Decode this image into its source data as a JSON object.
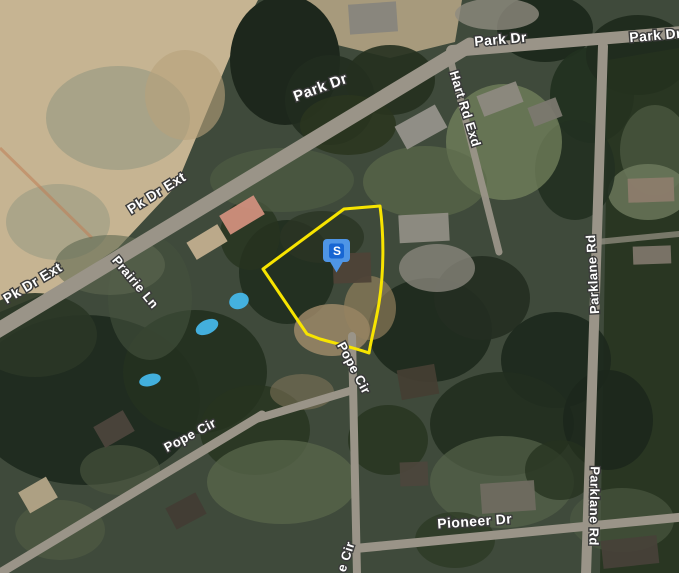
{
  "window": {
    "width": 679,
    "height": 573,
    "view": "satellite-map"
  },
  "map": {
    "marker": {
      "letter": "S",
      "tip_x": 336.5,
      "tip_y": 272.5,
      "outer_color": "#4e95e6",
      "inner_color": "#1766d3",
      "letter_color": "#ffffff"
    },
    "parcel": {
      "outline_color": "#f7e400",
      "outline_width": 3,
      "path": "M263,269 L344,209 L380,206 C384,235 384,272 379,303 C376,322 371,340 369,353 C358,349 338,344 320,339 L307,334 Z"
    },
    "road_labels": [
      {
        "text": "Park Dr",
        "x": 322,
        "y": 92,
        "rot": -20,
        "size": 15
      },
      {
        "text": "Park Dr",
        "x": 501,
        "y": 44,
        "rot": -5,
        "size": 14
      },
      {
        "text": "Park Dr",
        "x": 656,
        "y": 40,
        "rot": -5,
        "size": 14
      },
      {
        "text": "Hart Rd Exd",
        "x": 461,
        "y": 110,
        "rot": 73,
        "size": 13
      },
      {
        "text": "Pk Dr Ext",
        "x": 159,
        "y": 197,
        "rot": -32,
        "size": 14
      },
      {
        "text": "Pk Dr Ext",
        "x": 35,
        "y": 287,
        "rot": -31,
        "size": 14
      },
      {
        "text": "Prairie Ln",
        "x": 132,
        "y": 285,
        "rot": 50,
        "size": 13
      },
      {
        "text": "Pope Cir",
        "x": 350,
        "y": 370,
        "rot": 62,
        "size": 13
      },
      {
        "text": "Pope Cir",
        "x": 192,
        "y": 439,
        "rot": -28,
        "size": 13
      },
      {
        "text": "Parklane Rd",
        "x": 597,
        "y": 274,
        "rot": -93,
        "size": 13
      },
      {
        "text": "Parklane Rd",
        "x": 590,
        "y": 506,
        "rot": 91,
        "size": 13
      },
      {
        "text": "Pioneer Dr",
        "x": 475,
        "y": 526,
        "rot": -4,
        "size": 14
      },
      {
        "text": "e Cir",
        "x": 350,
        "y": 558,
        "rot": -72,
        "size": 13
      }
    ],
    "roads": [
      {
        "name": "pk-dr-ext-main",
        "x1": -8,
        "y1": 334,
        "x2": 470,
        "y2": 45,
        "w": 15,
        "o": 1
      },
      {
        "name": "park-dr-east",
        "x1": 452,
        "y1": 51,
        "x2": 683,
        "y2": 32,
        "w": 12,
        "o": 1
      },
      {
        "name": "hart-rd-exd",
        "x1": 450,
        "y1": 58,
        "x2": 499,
        "y2": 252,
        "w": 7,
        "o": 0.95
      },
      {
        "name": "parklane-rd",
        "x1": 603,
        "y1": 46,
        "x2": 586,
        "y2": 575,
        "w": 10,
        "o": 1
      },
      {
        "name": "pope-cir-sw",
        "x1": -5,
        "y1": 576,
        "x2": 262,
        "y2": 415,
        "w": 9,
        "o": 1
      },
      {
        "name": "pope-cir-mid",
        "x1": 256,
        "y1": 419,
        "x2": 353,
        "y2": 390,
        "w": 8,
        "o": 1
      },
      {
        "name": "pope-cir-ns",
        "x1": 352,
        "y1": 336,
        "x2": 357,
        "y2": 575,
        "w": 8,
        "o": 1
      },
      {
        "name": "pioneer-dr",
        "x1": 350,
        "y1": 549,
        "x2": 683,
        "y2": 517,
        "w": 9,
        "o": 1
      },
      {
        "name": "parklane-stub",
        "x1": 597,
        "y1": 242,
        "x2": 679,
        "y2": 234,
        "w": 6,
        "o": 0.7
      }
    ],
    "road_color": "#9a9488",
    "terrain": {
      "base_color": "#3f4a3b",
      "patches": [
        {
          "t": "poly",
          "pts": "0,0 258,0 236,42 176,186 118,248 58,288 0,312",
          "f": "#c6b492",
          "o": 1
        },
        {
          "t": "ell",
          "cx": 118,
          "cy": 118,
          "rx": 72,
          "ry": 52,
          "f": "#8f957f",
          "o": 0.55
        },
        {
          "t": "ell",
          "cx": 58,
          "cy": 222,
          "rx": 52,
          "ry": 38,
          "f": "#8f957f",
          "o": 0.5
        },
        {
          "t": "ell",
          "cx": 185,
          "cy": 95,
          "rx": 40,
          "ry": 45,
          "f": "#b7a27b",
          "o": 0.6
        },
        {
          "t": "line",
          "x1": 0,
          "y1": 148,
          "x2": 92,
          "y2": 238,
          "s": "#bf7e55",
          "w": 3,
          "o": 0.55
        },
        {
          "t": "poly",
          "pts": "300,0 462,0 455,42 390,58 325,42",
          "f": "#b3a384",
          "o": 0.9
        },
        {
          "t": "ell",
          "cx": 285,
          "cy": 60,
          "rx": 55,
          "ry": 65,
          "f": "#1d271c",
          "o": 1
        },
        {
          "t": "ell",
          "cx": 330,
          "cy": 100,
          "rx": 45,
          "ry": 45,
          "f": "#212c1f",
          "o": 0.9
        },
        {
          "t": "ell",
          "cx": 390,
          "cy": 80,
          "rx": 45,
          "ry": 35,
          "f": "#25301f",
          "o": 0.9
        },
        {
          "t": "ell",
          "cx": 348,
          "cy": 125,
          "rx": 48,
          "ry": 30,
          "f": "#2a351f",
          "o": 0.85
        },
        {
          "t": "ell",
          "cx": 545,
          "cy": 28,
          "rx": 48,
          "ry": 34,
          "f": "#1e2a1d",
          "o": 1
        },
        {
          "t": "ell",
          "cx": 592,
          "cy": 95,
          "rx": 42,
          "ry": 48,
          "f": "#223020",
          "o": 0.95
        },
        {
          "t": "ell",
          "cx": 638,
          "cy": 55,
          "rx": 52,
          "ry": 40,
          "f": "#202c1e",
          "o": 1
        },
        {
          "t": "poly",
          "pts": "608,60 679,48 679,573 600,573",
          "f": "#26321f",
          "o": 0.85
        },
        {
          "t": "ell",
          "cx": 655,
          "cy": 150,
          "rx": 35,
          "ry": 45,
          "f": "#55624a",
          "o": 0.6
        },
        {
          "t": "ell",
          "cx": 648,
          "cy": 192,
          "rx": 40,
          "ry": 28,
          "f": "#6e7a5e",
          "o": 0.8
        },
        {
          "t": "ell",
          "cx": 85,
          "cy": 400,
          "rx": 115,
          "ry": 85,
          "f": "#202c20",
          "o": 1
        },
        {
          "t": "ell",
          "cx": 195,
          "cy": 372,
          "rx": 72,
          "ry": 62,
          "f": "#243020",
          "o": 0.95
        },
        {
          "t": "ell",
          "cx": 35,
          "cy": 335,
          "rx": 62,
          "ry": 42,
          "f": "#2a3626",
          "o": 0.9
        },
        {
          "t": "ell",
          "cx": 255,
          "cy": 430,
          "rx": 55,
          "ry": 45,
          "f": "#27331f",
          "o": 0.8
        },
        {
          "t": "ell",
          "cx": 287,
          "cy": 272,
          "rx": 48,
          "ry": 52,
          "f": "#222e20",
          "o": 0.95
        },
        {
          "t": "ell",
          "cx": 322,
          "cy": 237,
          "rx": 42,
          "ry": 26,
          "f": "#2a3524",
          "o": 0.8
        },
        {
          "t": "ell",
          "cx": 250,
          "cy": 235,
          "rx": 30,
          "ry": 35,
          "f": "#27331f",
          "o": 0.8
        },
        {
          "t": "ell",
          "cx": 430,
          "cy": 330,
          "rx": 62,
          "ry": 52,
          "f": "#1f2a1e",
          "o": 0.95
        },
        {
          "t": "ell",
          "cx": 482,
          "cy": 298,
          "rx": 48,
          "ry": 42,
          "f": "#232e21",
          "o": 0.9
        },
        {
          "t": "ell",
          "cx": 556,
          "cy": 360,
          "rx": 55,
          "ry": 48,
          "f": "#1e291d",
          "o": 0.95
        },
        {
          "t": "ell",
          "cx": 502,
          "cy": 424,
          "rx": 72,
          "ry": 52,
          "f": "#212d1f",
          "o": 0.9
        },
        {
          "t": "ell",
          "cx": 608,
          "cy": 420,
          "rx": 45,
          "ry": 50,
          "f": "#1c271c",
          "o": 0.9
        },
        {
          "t": "ell",
          "cx": 575,
          "cy": 170,
          "rx": 40,
          "ry": 50,
          "f": "#223021",
          "o": 0.9
        },
        {
          "t": "ell",
          "cx": 504,
          "cy": 142,
          "rx": 58,
          "ry": 58,
          "f": "#74835d",
          "o": 0.75
        },
        {
          "t": "ell",
          "cx": 425,
          "cy": 182,
          "rx": 62,
          "ry": 36,
          "f": "#5c6a4b",
          "o": 0.65
        },
        {
          "t": "ell",
          "cx": 282,
          "cy": 180,
          "rx": 72,
          "ry": 32,
          "f": "#4e5b43",
          "o": 0.7
        },
        {
          "t": "ell",
          "cx": 150,
          "cy": 298,
          "rx": 42,
          "ry": 62,
          "f": "#44513e",
          "o": 0.6
        },
        {
          "t": "ell",
          "cx": 110,
          "cy": 265,
          "rx": 55,
          "ry": 30,
          "f": "#5d6850",
          "o": 0.6
        },
        {
          "t": "ell",
          "cx": 282,
          "cy": 482,
          "rx": 75,
          "ry": 42,
          "f": "#59674b",
          "o": 0.75
        },
        {
          "t": "ell",
          "cx": 502,
          "cy": 482,
          "rx": 72,
          "ry": 46,
          "f": "#55634a",
          "o": 0.7
        },
        {
          "t": "ell",
          "cx": 622,
          "cy": 520,
          "rx": 52,
          "ry": 32,
          "f": "#4e5b44",
          "o": 0.6
        },
        {
          "t": "ell",
          "cx": 332,
          "cy": 330,
          "rx": 38,
          "ry": 26,
          "f": "#a28c6b",
          "o": 0.8
        },
        {
          "t": "ell",
          "cx": 370,
          "cy": 308,
          "rx": 26,
          "ry": 32,
          "f": "#97825f",
          "o": 0.65
        },
        {
          "t": "ell",
          "cx": 302,
          "cy": 392,
          "rx": 32,
          "ry": 18,
          "f": "#8a7a5e",
          "o": 0.5
        },
        {
          "t": "ell",
          "cx": 437,
          "cy": 268,
          "rx": 38,
          "ry": 24,
          "f": "#8d8a80",
          "o": 0.75
        },
        {
          "t": "ell",
          "cx": 497,
          "cy": 14,
          "rx": 42,
          "ry": 16,
          "f": "#8f8b80",
          "o": 0.8
        },
        {
          "t": "ell",
          "cx": 120,
          "cy": 470,
          "rx": 40,
          "ry": 25,
          "f": "#4c5941",
          "o": 0.6
        },
        {
          "t": "ell",
          "cx": 60,
          "cy": 530,
          "rx": 45,
          "ry": 30,
          "f": "#515e45",
          "o": 0.6
        },
        {
          "t": "ell",
          "cx": 388,
          "cy": 440,
          "rx": 40,
          "ry": 35,
          "f": "#27331f",
          "o": 0.8
        },
        {
          "t": "ell",
          "cx": 455,
          "cy": 540,
          "rx": 40,
          "ry": 28,
          "f": "#2b3722",
          "o": 0.7
        },
        {
          "t": "ell",
          "cx": 560,
          "cy": 470,
          "rx": 35,
          "ry": 30,
          "f": "#25311f",
          "o": 0.75
        }
      ]
    },
    "houses": [
      [
        242,
        215,
        40,
        22,
        -31,
        "#d18f7d"
      ],
      [
        207,
        242,
        36,
        20,
        -31,
        "#c2ae8e"
      ],
      [
        373,
        18,
        48,
        30,
        -4,
        "#87857d"
      ],
      [
        421,
        127,
        46,
        26,
        -29,
        "#95918a"
      ],
      [
        500,
        99,
        42,
        22,
        -21,
        "#8d897f"
      ],
      [
        545,
        112,
        30,
        20,
        -21,
        "#7b786f"
      ],
      [
        352,
        268,
        38,
        30,
        -2,
        "#4e4237"
      ],
      [
        424,
        228,
        50,
        28,
        -3,
        "#908d84"
      ],
      [
        418,
        382,
        38,
        30,
        -10,
        "#453e33"
      ],
      [
        114,
        429,
        34,
        24,
        -30,
        "#4c443c"
      ],
      [
        38,
        495,
        32,
        24,
        -30,
        "#b3a487"
      ],
      [
        186,
        511,
        34,
        24,
        -28,
        "#423c34"
      ],
      [
        508,
        497,
        54,
        30,
        -4,
        "#6f6b60"
      ],
      [
        414,
        474,
        28,
        24,
        -2,
        "#4c463c"
      ],
      [
        630,
        552,
        56,
        28,
        -6,
        "#474139"
      ],
      [
        651,
        190,
        46,
        24,
        -2,
        "#8c7c6b"
      ],
      [
        652,
        255,
        38,
        18,
        -2,
        "#7d766a"
      ]
    ],
    "pools": [
      [
        239,
        301,
        10,
        8,
        -20
      ],
      [
        207,
        327,
        12,
        7,
        -25
      ],
      [
        150,
        380,
        11,
        6,
        -15
      ]
    ],
    "pool_color": "#45b6e8"
  }
}
